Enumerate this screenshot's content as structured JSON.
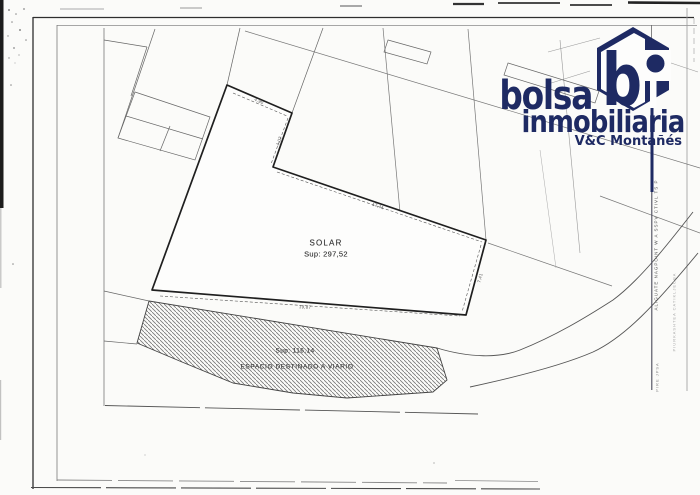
{
  "logo": {
    "word1": "bolsa",
    "word2": "inmobiliaria",
    "tagline": "V&C Montañés",
    "mark_b": "b",
    "navy": "#1e2a63"
  },
  "plan": {
    "solar_label": "SOLAR",
    "solar_area": "Sup: 297,52",
    "viario_area": "Sup: 116,14",
    "viario_label": "ESPACIO DESTINADO A VIARIO",
    "dimensions": [
      {
        "text": "4,90"
      },
      {
        "text": "4,07"
      },
      {
        "text": "17,41"
      },
      {
        "text": "19,87"
      },
      {
        "text": "7,41"
      }
    ]
  },
  "right_margin": {
    "vertical_text_1": "ALIGUATE NAGPOINT W A SSPV CTIVL TS P",
    "vertical_text_2": "PIURKASHTEA CATIKLJEOBA",
    "vertical_text_3": "PIRE JPSA"
  }
}
